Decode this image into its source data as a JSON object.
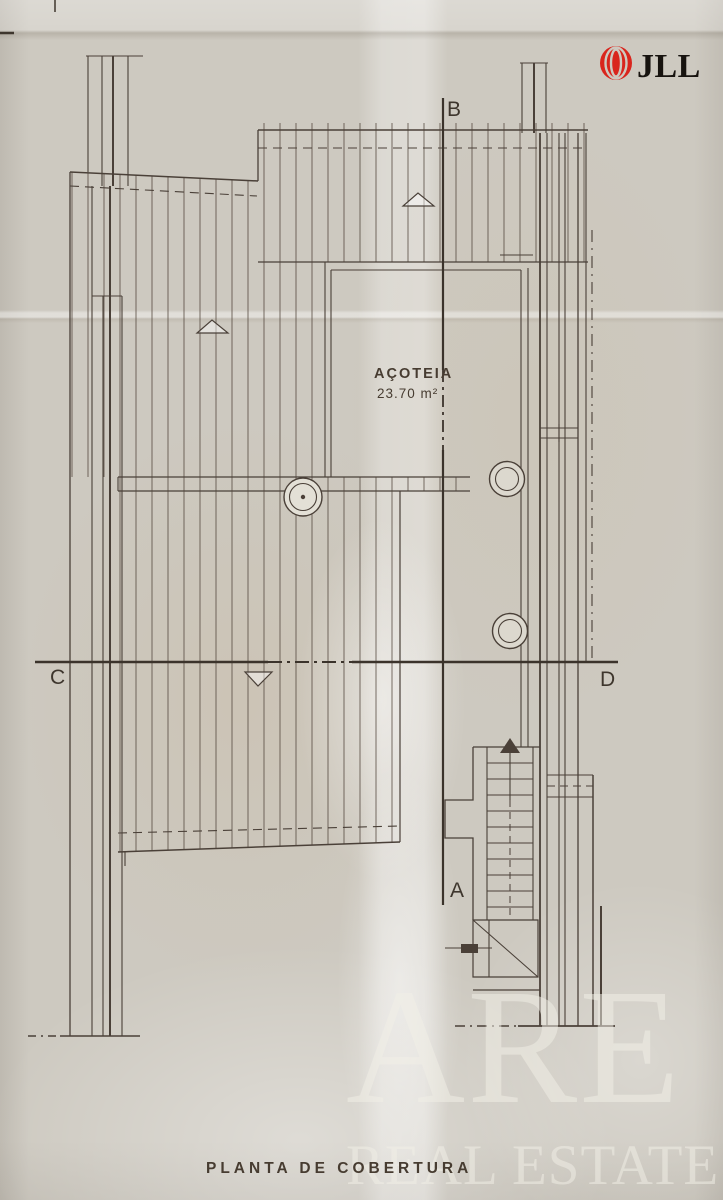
{
  "branding": {
    "logo_text": "JLL",
    "logo_red": "#d9251d"
  },
  "plan": {
    "caption": "PLANTA  DE  COBERTURA",
    "area_label": "AÇOTEIA",
    "area_value": "23.70 m²",
    "markers": {
      "top": "B",
      "bottom": "A",
      "left": "C",
      "right": "D"
    }
  },
  "watermark": {
    "line1": "ARE",
    "line2": "REAL ESTATE"
  },
  "colors": {
    "paper": "#cdc9c0",
    "ink": "#4a4038",
    "section_ink": "#3b332b"
  }
}
